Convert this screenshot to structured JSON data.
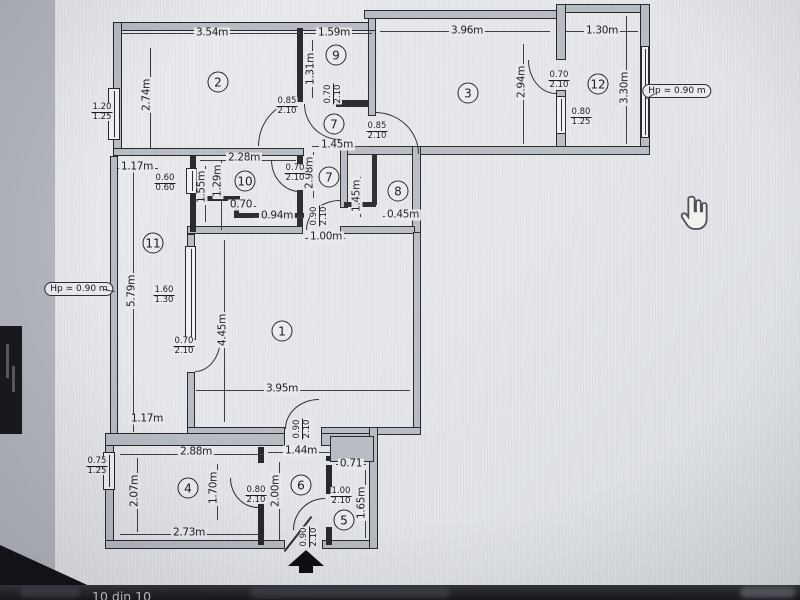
{
  "viewer": {
    "status_bar_text": "10 din 10",
    "cursor": "hand-pointer"
  },
  "floor_plan": {
    "room_numbers": [
      {
        "label": "1",
        "x": 282,
        "y": 331
      },
      {
        "label": "2",
        "x": 218,
        "y": 82
      },
      {
        "label": "3",
        "x": 468,
        "y": 93
      },
      {
        "label": "4",
        "x": 188,
        "y": 488
      },
      {
        "label": "5",
        "x": 344,
        "y": 520
      },
      {
        "label": "6",
        "x": 301,
        "y": 485
      },
      {
        "label": "7",
        "x": 334,
        "y": 124
      },
      {
        "label": "7",
        "x": 329,
        "y": 177
      },
      {
        "label": "8",
        "x": 398,
        "y": 191
      },
      {
        "label": "9",
        "x": 336,
        "y": 55
      },
      {
        "label": "10",
        "x": 245,
        "y": 181
      },
      {
        "label": "11",
        "x": 153,
        "y": 243
      },
      {
        "label": "12",
        "x": 598,
        "y": 84
      }
    ],
    "dimensions_horizontal": [
      {
        "text": "3.54m",
        "x": 212,
        "y": 33
      },
      {
        "text": "1.59m",
        "x": 334,
        "y": 33
      },
      {
        "text": "3.96m",
        "x": 467,
        "y": 31
      },
      {
        "text": "1.30m",
        "x": 602,
        "y": 31
      },
      {
        "text": "1.17m",
        "x": 137,
        "y": 167
      },
      {
        "text": "2.28m",
        "x": 244,
        "y": 158
      },
      {
        "text": "0.70",
        "x": 241,
        "y": 205
      },
      {
        "text": "0.94m",
        "x": 277,
        "y": 216
      },
      {
        "text": "1.45m",
        "x": 337,
        "y": 145
      },
      {
        "text": "0.45m",
        "x": 403,
        "y": 215
      },
      {
        "text": "1.00m",
        "x": 326,
        "y": 237
      },
      {
        "text": "3.95m",
        "x": 282,
        "y": 389
      },
      {
        "text": "1.17m",
        "x": 147,
        "y": 419
      },
      {
        "text": "2.88m",
        "x": 196,
        "y": 452
      },
      {
        "text": "1.44m",
        "x": 301,
        "y": 451
      },
      {
        "text": "0.71",
        "x": 351,
        "y": 464
      },
      {
        "text": "2.73m",
        "x": 189,
        "y": 533
      }
    ],
    "dimensions_vertical": [
      {
        "text": "2.74m",
        "x": 147,
        "y": 95
      },
      {
        "text": "1.31m",
        "x": 311,
        "y": 69
      },
      {
        "text": "2.94m",
        "x": 522,
        "y": 82
      },
      {
        "text": "3.30m",
        "x": 625,
        "y": 88
      },
      {
        "text": "1.55m",
        "x": 202,
        "y": 187
      },
      {
        "text": "1.29m",
        "x": 218,
        "y": 181
      },
      {
        "text": "2.98m",
        "x": 310,
        "y": 173
      },
      {
        "text": "1.45m",
        "x": 357,
        "y": 196
      },
      {
        "text": "5.79m",
        "x": 132,
        "y": 291
      },
      {
        "text": "4.45m",
        "x": 223,
        "y": 330
      },
      {
        "text": "2.07m",
        "x": 135,
        "y": 491
      },
      {
        "text": "1.70m",
        "x": 214,
        "y": 488
      },
      {
        "text": "2.00m",
        "x": 276,
        "y": 491
      },
      {
        "text": "1.65m",
        "x": 362,
        "y": 503
      }
    ],
    "opening_specs": [
      {
        "width": "1.20",
        "height": "1.25",
        "x": 102,
        "y": 112,
        "rotated": false
      },
      {
        "width": "0.85",
        "height": "2.10",
        "x": 287,
        "y": 106,
        "rotated": false
      },
      {
        "width": "0.70",
        "height": "2.10",
        "x": 333,
        "y": 94,
        "rotated": true
      },
      {
        "width": "0.85",
        "height": "2.10",
        "x": 377,
        "y": 131,
        "rotated": false
      },
      {
        "width": "0.70",
        "height": "2.10",
        "x": 559,
        "y": 80,
        "rotated": false
      },
      {
        "width": "0.80",
        "height": "1.25",
        "x": 581,
        "y": 117,
        "rotated": false
      },
      {
        "width": "0.70",
        "height": "2.10",
        "x": 295,
        "y": 173,
        "rotated": false
      },
      {
        "width": "0.60",
        "height": "0.60",
        "x": 165,
        "y": 183,
        "rotated": false
      },
      {
        "width": "1.60",
        "height": "1.30",
        "x": 164,
        "y": 295,
        "rotated": false
      },
      {
        "width": "0.70",
        "height": "2.10",
        "x": 184,
        "y": 346,
        "rotated": false
      },
      {
        "width": "0.90",
        "height": "2.10",
        "x": 319,
        "y": 216,
        "rotated": true
      },
      {
        "width": "0.90",
        "height": "2.10",
        "x": 302,
        "y": 429,
        "rotated": true
      },
      {
        "width": "0.90",
        "height": "2.10",
        "x": 309,
        "y": 537,
        "rotated": true
      },
      {
        "width": "0.75",
        "height": "1.25",
        "x": 97,
        "y": 466,
        "rotated": false
      },
      {
        "width": "0.80",
        "height": "2.10",
        "x": 256,
        "y": 495,
        "rotated": false
      },
      {
        "width": "1.00",
        "height": "2.10",
        "x": 341,
        "y": 496,
        "rotated": false
      }
    ],
    "height_labels": [
      {
        "text": "Hp = 0.90 m",
        "x": 677,
        "y": 91
      },
      {
        "text": "Hp = 0.90 m",
        "x": 79,
        "y": 289
      }
    ]
  }
}
